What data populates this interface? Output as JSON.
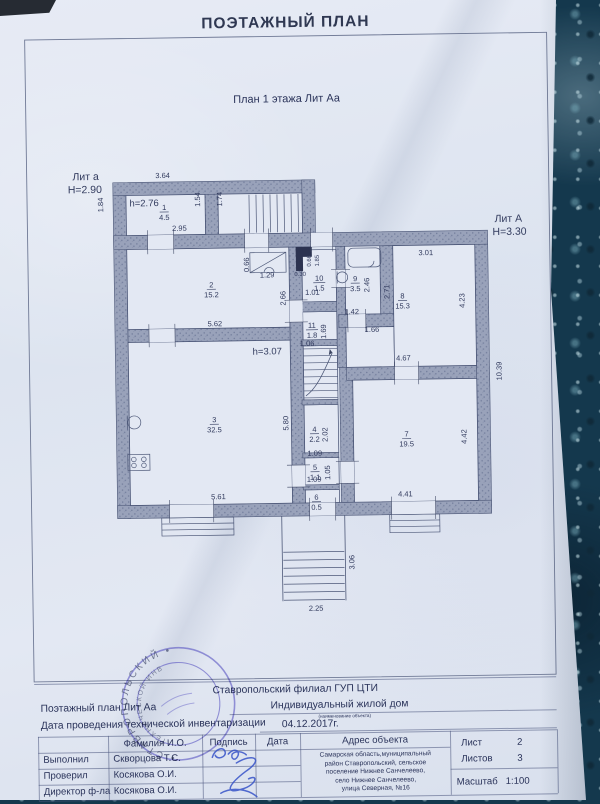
{
  "title": "ПОЭТАЖНЫЙ ПЛАН",
  "subtitle": "План 1 этажа Лит Аа",
  "plan": {
    "rooms": [
      {
        "n": "1",
        "a": "4.5",
        "x": 167,
        "y": 208
      },
      {
        "n": "2",
        "a": "15.2",
        "x": 213,
        "y": 286
      },
      {
        "n": "3",
        "a": "32.5",
        "x": 214,
        "y": 421
      },
      {
        "n": "4",
        "a": "2.2",
        "x": 314,
        "y": 432
      },
      {
        "n": "5",
        "a": "1.1",
        "x": 314,
        "y": 470
      },
      {
        "n": "6",
        "a": "0.5",
        "x": 315,
        "y": 500
      },
      {
        "n": "7",
        "a": "19.5",
        "x": 406,
        "y": 438
      },
      {
        "n": "8",
        "a": "15.3",
        "x": 404,
        "y": 300
      },
      {
        "n": "9",
        "a": "3.5",
        "x": 357,
        "y": 282
      },
      {
        "n": "10",
        "a": "1.5",
        "x": 321,
        "y": 281
      },
      {
        "n": "11",
        "a": "1.8",
        "x": 313,
        "y": 328
      }
    ],
    "labels": [
      {
        "t": "Лит а",
        "x": 89,
        "y": 177,
        "s": 10.5
      },
      {
        "t": "Н=2.90",
        "x": 88,
        "y": 190,
        "s": 10.5
      },
      {
        "t": "3.64",
        "x": 166,
        "y": 176
      },
      {
        "t": "1.84",
        "x": 106,
        "y": 202,
        "r": 1
      },
      {
        "t": "h=2.76",
        "x": 147,
        "y": 204,
        "s": 9.5
      },
      {
        "t": "2.95",
        "x": 182,
        "y": 229
      },
      {
        "t": "1.54",
        "x": 203,
        "y": 198,
        "r": 1
      },
      {
        "t": "1.74",
        "x": 225,
        "y": 198,
        "r": 1
      },
      {
        "t": "Лит А",
        "x": 511,
        "y": 225,
        "s": 10.5
      },
      {
        "t": "Н=3.30",
        "x": 512,
        "y": 238,
        "s": 10.5
      },
      {
        "t": "5.62",
        "x": 216,
        "y": 325
      },
      {
        "t": "0.66",
        "x": 251,
        "y": 264,
        "r": 1
      },
      {
        "t": "1.29",
        "x": 269,
        "y": 277
      },
      {
        "t": "0.30",
        "x": 302,
        "y": 276,
        "s": 6
      },
      {
        "t": "1.01",
        "x": 314,
        "y": 295
      },
      {
        "t": "0.66",
        "x": 313,
        "y": 261,
        "r": 1,
        "s": 6
      },
      {
        "t": "1.85",
        "x": 321,
        "y": 261,
        "r": 1,
        "s": 6
      },
      {
        "t": "2.66",
        "x": 287,
        "y": 298,
        "r": 1
      },
      {
        "t": "2.46",
        "x": 371,
        "y": 286,
        "r": 1
      },
      {
        "t": "2.71",
        "x": 391,
        "y": 293,
        "r": 1
      },
      {
        "t": "3.01",
        "x": 428,
        "y": 257
      },
      {
        "t": "4.23",
        "x": 466,
        "y": 303,
        "r": 1
      },
      {
        "t": "1.42",
        "x": 353,
        "y": 315
      },
      {
        "t": "1.66",
        "x": 373,
        "y": 333
      },
      {
        "t": "1.69",
        "x": 327,
        "y": 332,
        "r": 1
      },
      {
        "t": "1.06",
        "x": 308,
        "y": 346
      },
      {
        "t": "h=3.07",
        "x": 268,
        "y": 354,
        "s": 9.5
      },
      {
        "t": "4.67",
        "x": 404,
        "y": 362
      },
      {
        "t": "10.39",
        "x": 502,
        "y": 374,
        "r": 1
      },
      {
        "t": "5.80",
        "x": 288,
        "y": 423,
        "r": 1
      },
      {
        "t": "2.02",
        "x": 327,
        "y": 435,
        "r": 1
      },
      {
        "t": "1.09",
        "x": 314,
        "y": 456
      },
      {
        "t": "1.05",
        "x": 329,
        "y": 473,
        "r": 1
      },
      {
        "t": "1.09",
        "x": 313,
        "y": 482
      },
      {
        "t": "4.42",
        "x": 466,
        "y": 439,
        "r": 1
      },
      {
        "t": "5.61",
        "x": 217,
        "y": 498
      },
      {
        "t": "4.41",
        "x": 404,
        "y": 498
      },
      {
        "t": "3.06",
        "x": 352,
        "y": 563,
        "r": 1
      },
      {
        "t": "2.25",
        "x": 313,
        "y": 611
      }
    ]
  },
  "footer": {
    "org": "Ставропольский  филиал ГУП ЦТИ",
    "plan_label": "Поэтажный план Лит Аа",
    "object_type": "Индивидуальный жилой дом",
    "object_note": "(наименование объекта)",
    "date_label": "Дата проведения технической инвентаризации",
    "date_value": "04.12.2017г.",
    "col_headers": [
      "Фамилия И.О.",
      "Подпись",
      "Дата",
      "Адрес объекта"
    ],
    "rows": [
      {
        "role": "Выполнил",
        "name": "Скворцова Т.С."
      },
      {
        "role": "Проверил",
        "name": "Косякова О.И."
      },
      {
        "role": "Директор ф-ла",
        "name": "Косякова О.И."
      }
    ],
    "address_lines": [
      "Самарская область,муниципальный",
      "район Ставропольский, сельское",
      "поселение Нижнее Санчелеево,",
      "село Нижнее Санчелеево,",
      "улица Северная, №16"
    ],
    "sheet_label": "Лист",
    "sheet_value": "2",
    "sheets_label": "Листов",
    "sheets_value": "3",
    "scale_label": "Масштаб",
    "scale_value": "1:100"
  },
  "stamp": {
    "outer": "• СТАВРОПОЛЬСКИЙ •",
    "inner": "ТЕХНИЧЕСКОЙ ИНВ"
  },
  "colors": {
    "paper": "#dfe5f0",
    "ink": "#2a335a",
    "wall": "#99a2ba",
    "stamp_blue": "#5a55c2",
    "signature_blue": "#3753c8",
    "background_teal": "#14384d"
  }
}
